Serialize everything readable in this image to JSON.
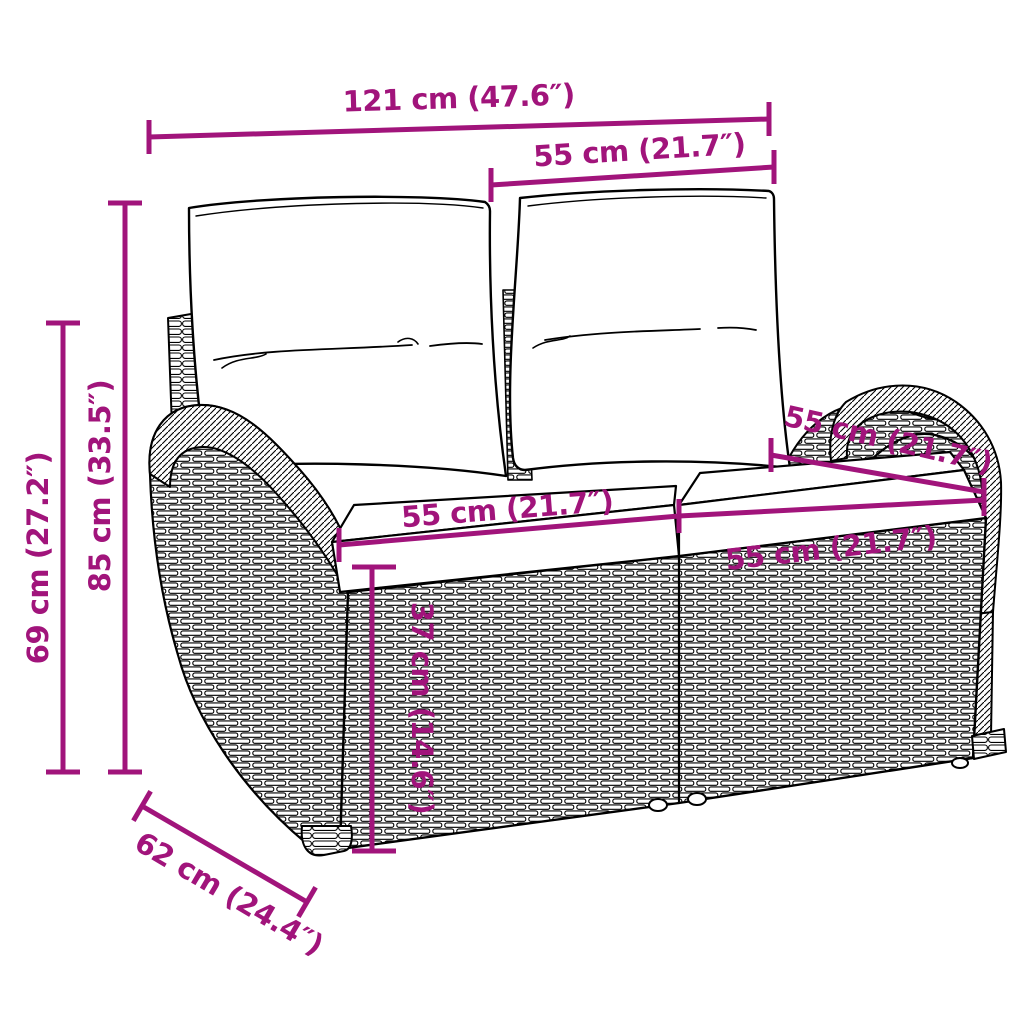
{
  "diagram": {
    "type": "product-dimension-diagram",
    "subject": "rattan-garden-bench-with-cushions",
    "background_color": "#ffffff",
    "accent_color": "#A1147B",
    "outline_color": "#000000",
    "dimensions": [
      {
        "id": "overall-width",
        "label": "121 cm (47.6″)",
        "value_cm": 121,
        "value_in": 47.6
      },
      {
        "id": "backrest-width",
        "label": "55 cm (21.7″)",
        "value_cm": 55,
        "value_in": 21.7
      },
      {
        "id": "overall-height",
        "label": "85 cm (33.5″)",
        "value_cm": 85,
        "value_in": 33.5
      },
      {
        "id": "armrest-height",
        "label": "69 cm (27.2″)",
        "value_cm": 69,
        "value_in": 27.2
      },
      {
        "id": "seat-width-left",
        "label": "55 cm (21.7″)",
        "value_cm": 55,
        "value_in": 21.7
      },
      {
        "id": "seat-width-right",
        "label": "55 cm (21.7″)",
        "value_cm": 55,
        "value_in": 21.7
      },
      {
        "id": "seat-depth-top",
        "label": "55 cm (21.7″)",
        "value_cm": 55,
        "value_in": 21.7
      },
      {
        "id": "seat-height",
        "label": "37 cm (14.6″)",
        "value_cm": 37,
        "value_in": 14.6
      },
      {
        "id": "overall-depth",
        "label": "62 cm (24.4″)",
        "value_cm": 62,
        "value_in": 24.4
      }
    ]
  }
}
